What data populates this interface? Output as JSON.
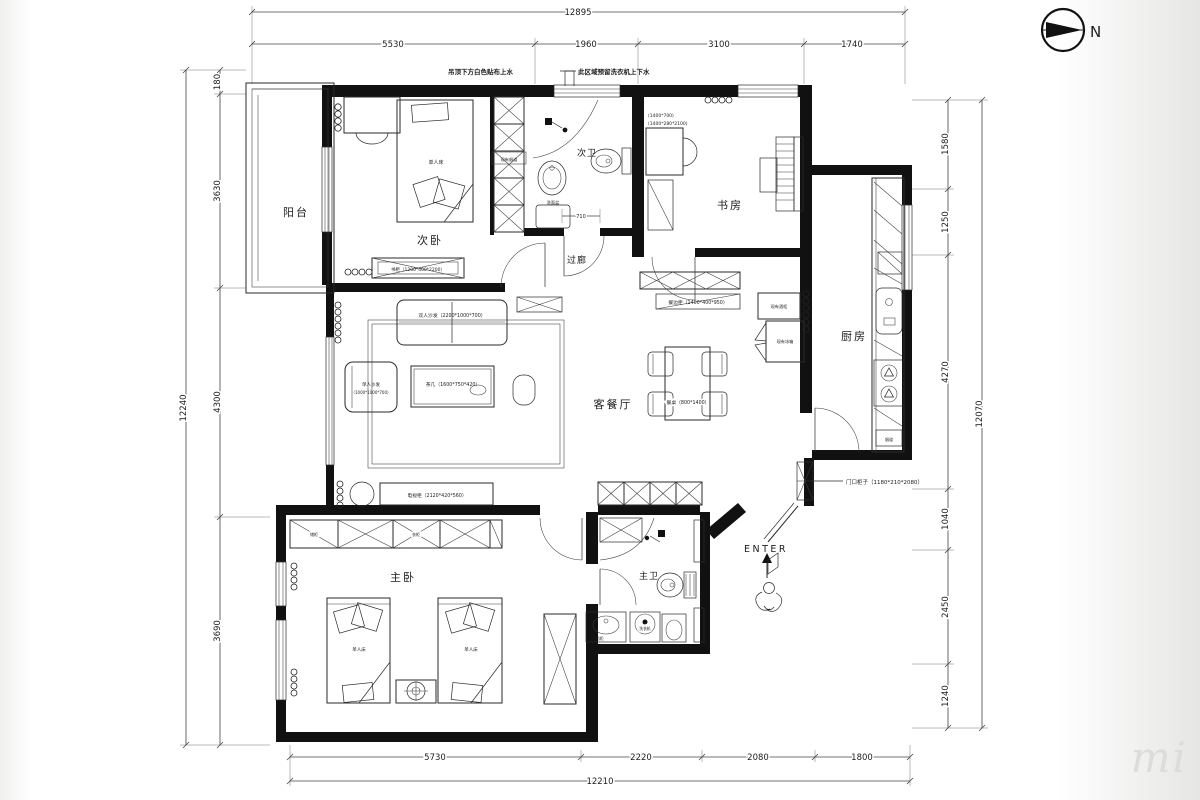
{
  "compass": {
    "north_label": "N"
  },
  "watermark": {
    "text": "mi"
  },
  "notes": {
    "left": "吊顶下方白色贴布上水",
    "right": "此区域预留洗衣机上下水"
  },
  "dims": {
    "top": {
      "total": "12895",
      "segments": [
        "5530",
        "1960",
        "3100",
        "1740"
      ]
    },
    "bottom": {
      "total": "12210",
      "segments": [
        "5730",
        "2220",
        "2080",
        "1800"
      ]
    },
    "left": {
      "total": "12240",
      "segments": [
        "180",
        "3630",
        "4300",
        "3690"
      ]
    },
    "right": {
      "total": "12070",
      "segments": [
        "1580",
        "1250",
        "4270",
        "1040",
        "2450",
        "1240"
      ]
    },
    "door_width": "710"
  },
  "rooms": {
    "balcony": "阳台",
    "bedroom2": "次卧",
    "bath2": "次卫",
    "study": "书房",
    "corridor": "过廊",
    "kitchen": "厨房",
    "living": "客餐厅",
    "master": "主卧",
    "bath1": "主卫",
    "entry": "ENTER"
  },
  "furniture": {
    "single_bed": "单人床",
    "bookcase": "书柜（1200*400*2200）",
    "sofa_double": "双人沙发（2200*1000*700）",
    "sofa_single_line1": "单人沙发",
    "sofa_single_line2": "（1000*1000*700）",
    "tea_table": "茶几（1600*750*420）",
    "tv_cabinet": "电视柜（2120*420*560）",
    "sideboard": "餐边柜（1400*400*950）",
    "dining_table": "餐桌（800*1400）",
    "wine_cabinet": "现有酒柜",
    "fridge": "现有冰箱",
    "desk_dims": "(1400*700)",
    "bookshelf_dims": "(1400*280*2100)",
    "entry_cabinet": "门口柜子（1180*210*2080）",
    "washbasin": "洗面盆",
    "vanity": "卫浴柜",
    "washer": "洗衣机",
    "flue": "现有烟道",
    "kitchen_flue": "烟道",
    "wardrobe_a": "储柜",
    "wardrobe_b": "衣柜"
  }
}
